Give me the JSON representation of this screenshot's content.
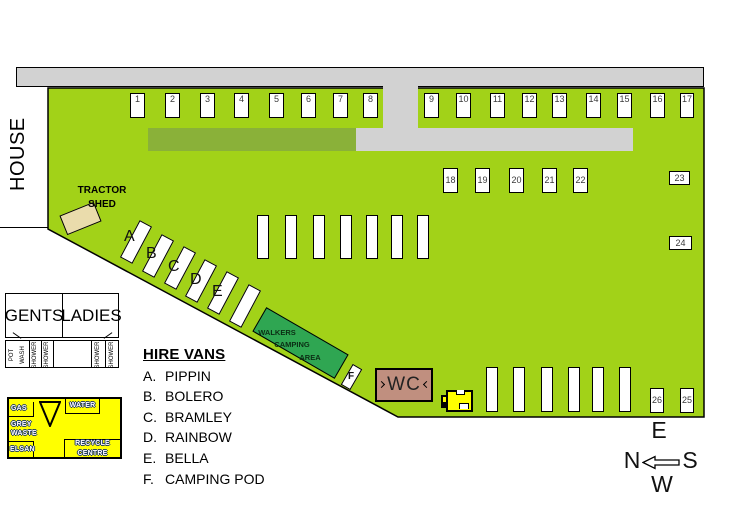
{
  "house": {
    "label": "HOUSE"
  },
  "tractor_shed": {
    "line1": "TRACTOR",
    "line2": "SHED"
  },
  "pitch_numbers": {
    "p1": "1",
    "p2": "2",
    "p3": "3",
    "p4": "4",
    "p5": "5",
    "p6": "6",
    "p7": "7",
    "p8": "8",
    "p9": "9",
    "p10": "10",
    "p11": "11",
    "p12": "12",
    "p13": "13",
    "p14": "14",
    "p15": "15",
    "p16": "16",
    "p17": "17",
    "p18": "18",
    "p19": "19",
    "p20": "20",
    "p21": "21",
    "p22": "22",
    "p23": "23",
    "p24": "24",
    "p25": "25",
    "p26": "26"
  },
  "hire_van_letters": {
    "a": "A",
    "b": "B",
    "c": "C",
    "d": "D",
    "e": "E",
    "f": "F"
  },
  "walkers_area": {
    "line1": "WALKERS",
    "line2": "CAMPING",
    "line3": "AREA"
  },
  "wc": {
    "label": "WC"
  },
  "toilet_block": {
    "gents": "GENTS",
    "ladies": "LADIES",
    "pot": "POT",
    "wash": "WASH",
    "shower": "SHOWER"
  },
  "utility_block": {
    "gas": "GAS",
    "grey": "GREY",
    "waste": "WASTE",
    "elsan": "ELSAN",
    "water": "WATER",
    "recycle_line1": "RECYCLE",
    "recycle_line2": "CENTRE"
  },
  "hire_vans": {
    "heading": "HIRE VANS",
    "items": [
      {
        "letter": "A.",
        "name": "PIPPIN"
      },
      {
        "letter": "B.",
        "name": "BOLERO"
      },
      {
        "letter": "C.",
        "name": "BRAMLEY"
      },
      {
        "letter": "D.",
        "name": "RAINBOW"
      },
      {
        "letter": "E.",
        "name": "BELLA"
      },
      {
        "letter": "F.",
        "name": "CAMPING POD"
      }
    ]
  },
  "compass": {
    "top": "E",
    "left": "N",
    "right": "S",
    "bottom": "W"
  },
  "colors": {
    "field_green": "#a2d218",
    "track_dark_green": "#8ab139",
    "walkers_green": "#2fa652",
    "road_gray": "#d2d2d2",
    "shed_tan": "#eadcac",
    "wc_brown": "#c08f7f",
    "utility_yellow": "#ffff00",
    "outline_black": "#000000"
  }
}
